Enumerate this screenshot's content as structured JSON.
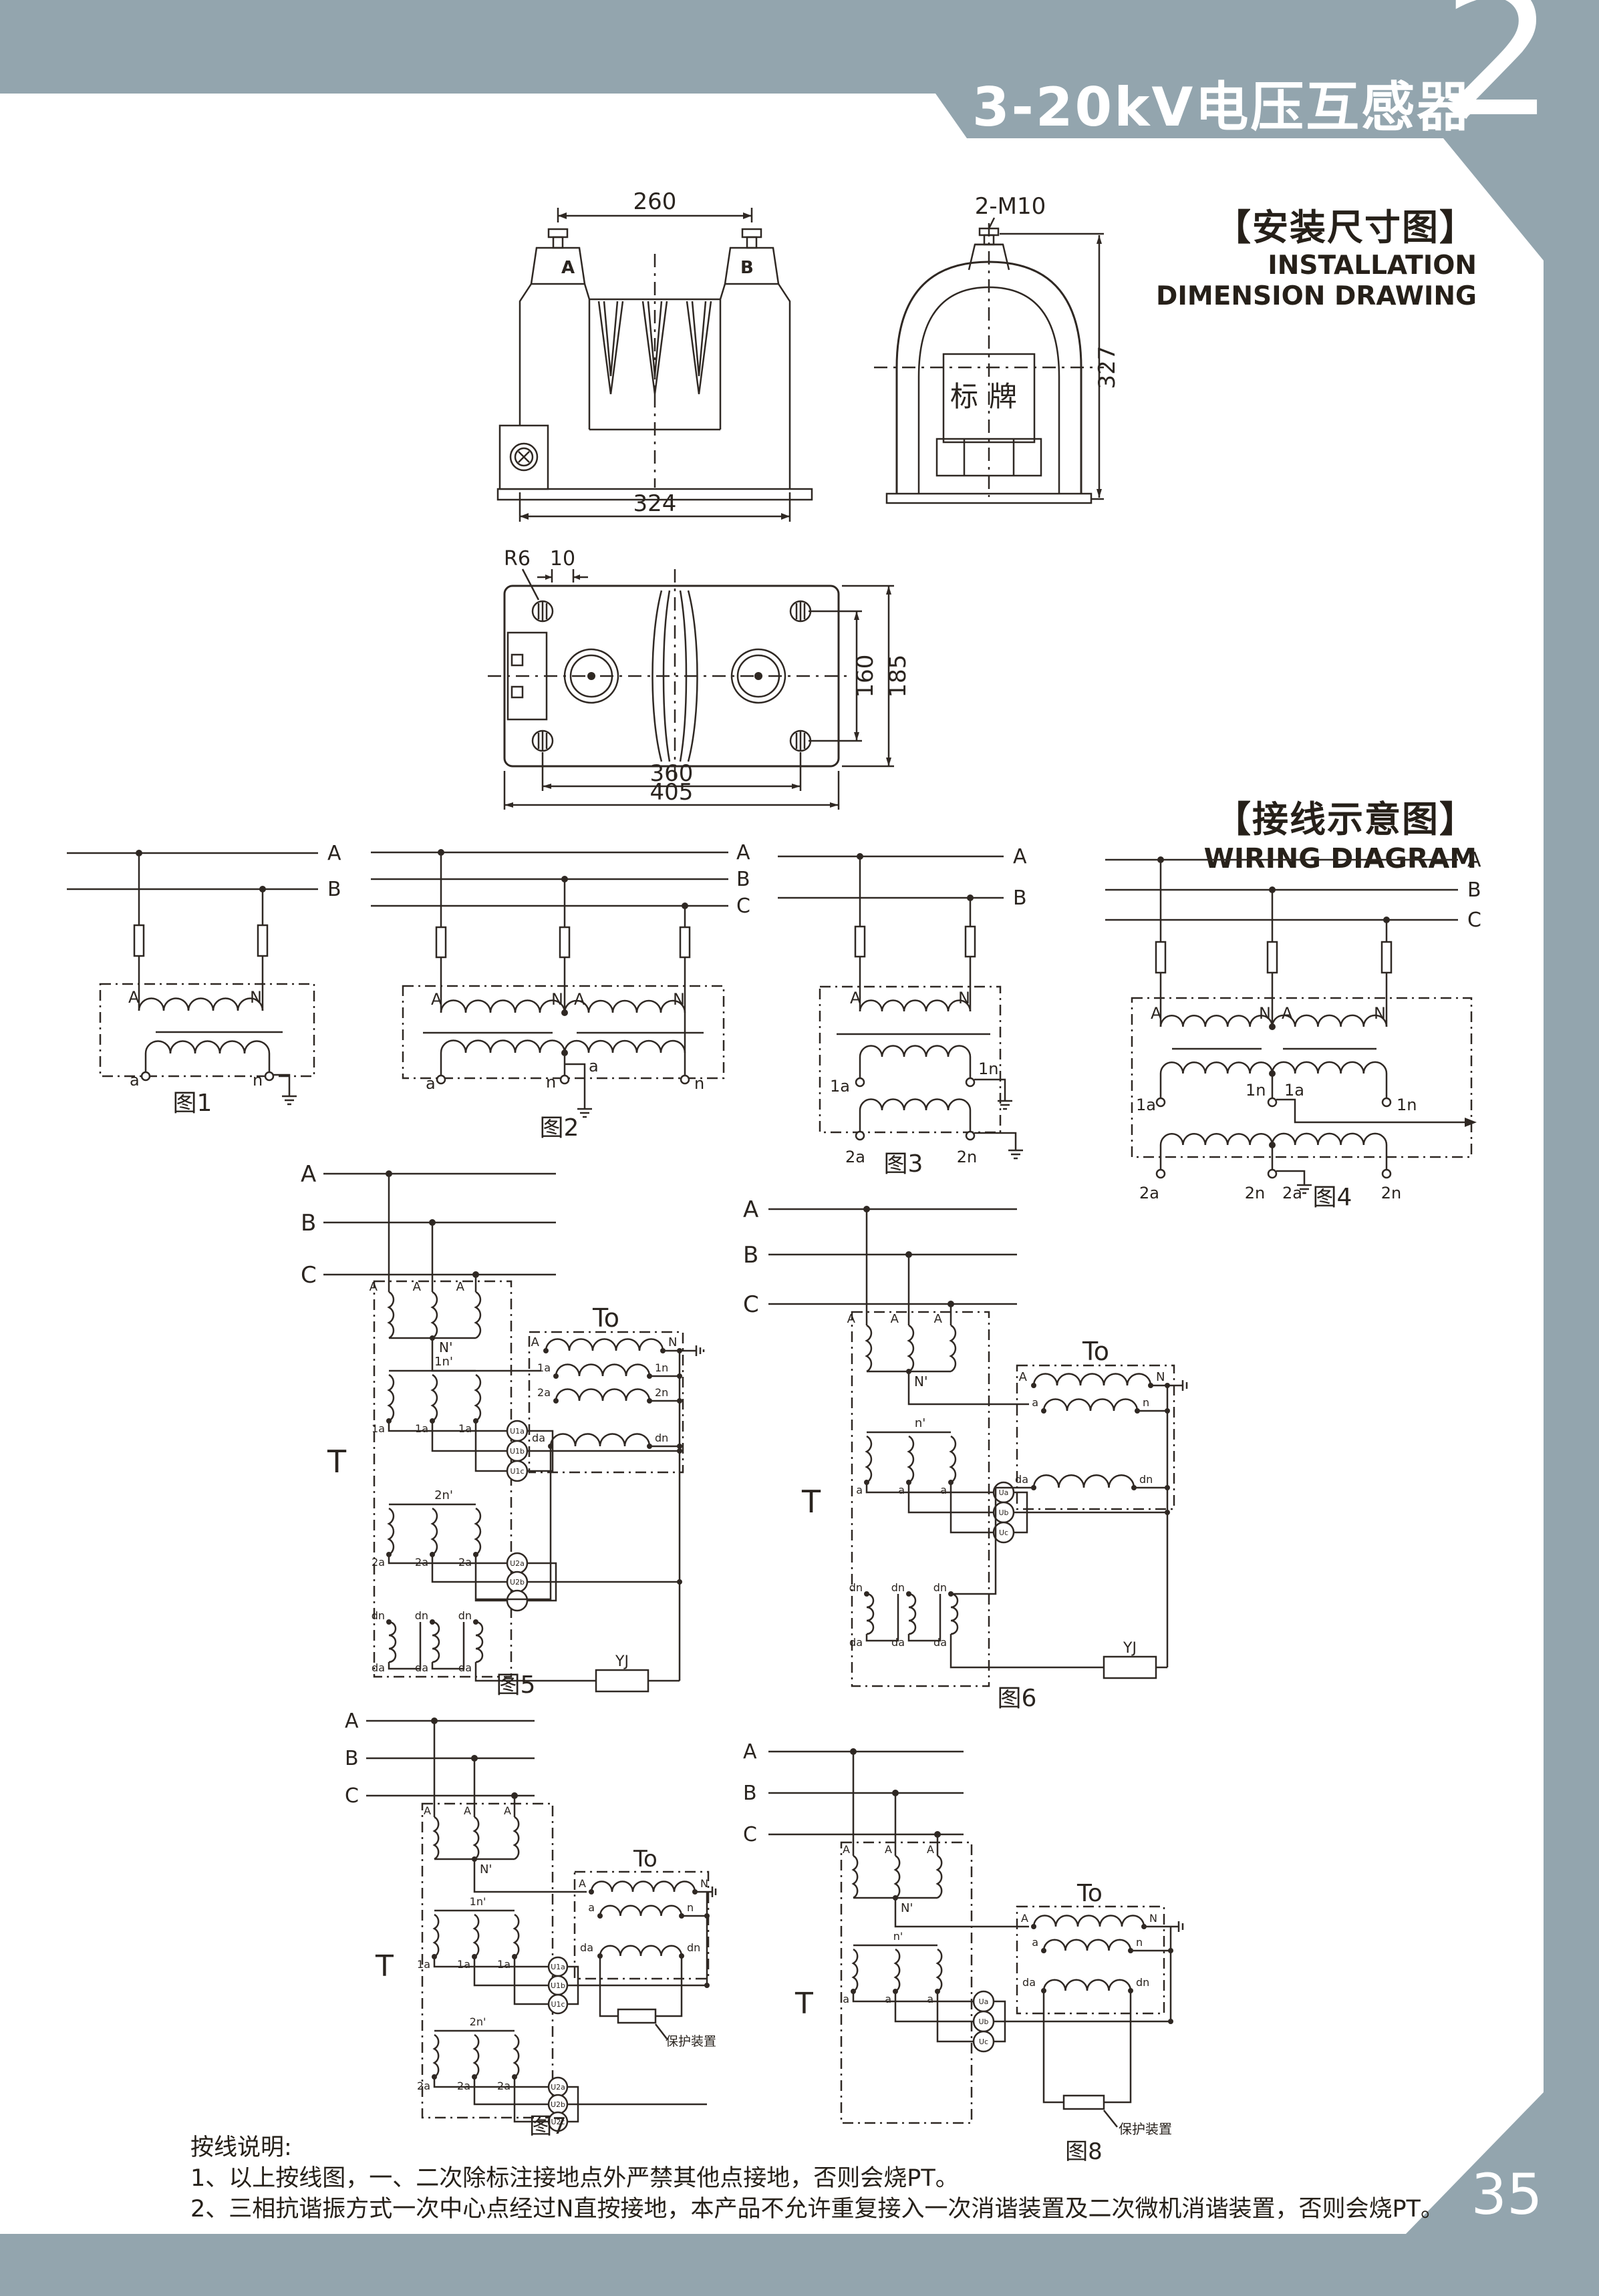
{
  "page": {
    "number": "35"
  },
  "header": {
    "title": "3-20kV电压互感器",
    "chapter": "2"
  },
  "install_section": {
    "zh": "【安装尺寸图】",
    "en_line1": "INSTALLATION",
    "en_line2": "DIMENSION DRAWING"
  },
  "wiring_section": {
    "zh": "【接线示意图】",
    "en": "WIRING DIAGRAM"
  },
  "front_view": {
    "dim_top": "260",
    "dim_bottom": "324",
    "label_a": "A",
    "label_b": "B"
  },
  "side_view": {
    "bolt_label": "2-M10",
    "nameplate": "标牌",
    "dim_height": "327"
  },
  "top_view": {
    "label_r": "R6",
    "label_10": "10",
    "dim_160": "160",
    "dim_185": "185",
    "dim_360": "360",
    "dim_405": "405"
  },
  "fig1": {
    "caption": "图1",
    "bus_a": "A",
    "bus_b": "B",
    "prim_a": "A",
    "prim_n": "N",
    "sec_a": "a",
    "sec_n": "n"
  },
  "fig2": {
    "caption": "图2",
    "bus_a": "A",
    "bus_b": "B",
    "bus_c": "C",
    "prim_a1": "A",
    "prim_n1": "N",
    "prim_a2": "A",
    "prim_n2": "N",
    "sec_a1": "a",
    "sec_n1": "n",
    "sec_tap": "a",
    "sec_n2": "n"
  },
  "fig3": {
    "caption": "图3",
    "bus_a": "A",
    "bus_b": "B",
    "prim_a": "A",
    "prim_n": "N",
    "sec1_a": "1a",
    "sec1_n": "1n",
    "sec2_a": "2a",
    "sec2_n": "2n"
  },
  "fig4": {
    "caption": "图4",
    "bus_a": "A",
    "bus_b": "B",
    "bus_c": "C",
    "prim_a1": "A",
    "prim_n1": "N",
    "prim_a2": "A",
    "prim_n2": "N",
    "sec1_a1": "1a",
    "sec1_n1": "1n",
    "sec1_a2": "1a",
    "sec1_n2": "1n",
    "sec2_a1": "2a",
    "sec2_n1": "2n",
    "sec2_a2": "2a",
    "sec2_n2": "2n"
  },
  "fig5": {
    "caption": "图5",
    "t": "T",
    "to": "To",
    "bus_a": "A",
    "bus_b": "B",
    "bus_c": "C",
    "p1": "A",
    "p2": "A",
    "p3": "A",
    "np": "N'",
    "r2_top": "1n'",
    "r2_b1": "1a",
    "r2_b2": "1a",
    "r2_b3": "1a",
    "r3_top": "2n'",
    "r3_b1": "2a",
    "r3_b2": "2a",
    "r3_b3": "2a",
    "r4_t1": "dn",
    "r4_t2": "dn",
    "r4_t3": "dn",
    "r4_b1": "da",
    "r4_b2": "da",
    "r4_b3": "da",
    "lamp1": "U1a",
    "lamp2": "U1b",
    "lamp3": "U1c",
    "lamp4": "U2a",
    "lamp5": "U2b",
    "lamp6": "U2c",
    "to_a": "A",
    "to_n": "N",
    "to_1a": "1a",
    "to_1n": "1n",
    "to_2a": "2a",
    "to_2n": "2n",
    "to_da": "da",
    "to_dn": "dn",
    "yj": "YJ"
  },
  "fig6": {
    "caption": "图6",
    "t": "T",
    "to": "To",
    "bus_a": "A",
    "bus_b": "B",
    "bus_c": "C",
    "p1": "A",
    "p2": "A",
    "p3": "A",
    "np": "N'",
    "r2_top": "n'",
    "r2_b1": "a",
    "r2_b2": "a",
    "r2_b3": "a",
    "r3_t1": "dn",
    "r3_t2": "dn",
    "r3_t3": "dn",
    "r3_b1": "da",
    "r3_b2": "da",
    "r3_b3": "da",
    "lamp1": "Ua",
    "lamp2": "Ub",
    "lamp3": "Uc",
    "to_a": "A",
    "to_n": "N",
    "to_sa": "a",
    "to_sn": "n",
    "to_da": "da",
    "to_dn": "dn",
    "yj": "YJ"
  },
  "fig7": {
    "caption": "图7",
    "t": "T",
    "to": "To",
    "bus_a": "A",
    "bus_b": "B",
    "bus_c": "C",
    "p1": "A",
    "p2": "A",
    "p3": "A",
    "np": "N'",
    "r2_top": "1n'",
    "r2_b1": "1a",
    "r2_b2": "1a",
    "r2_b3": "1a",
    "r3_top": "2n'",
    "r3_b1": "2a",
    "r3_b2": "2a",
    "r3_b3": "2a",
    "lamp1": "U1a",
    "lamp2": "U1b",
    "lamp3": "U1c",
    "lamp4": "U2a",
    "lamp5": "U2b",
    "lamp6": "U2c",
    "to_a": "A",
    "to_n": "N",
    "to_sa": "a",
    "to_sn": "n",
    "to_da": "da",
    "to_dn": "dn",
    "protect": "保护装置"
  },
  "fig8": {
    "caption": "图8",
    "t": "T",
    "to": "To",
    "bus_a": "A",
    "bus_b": "B",
    "bus_c": "C",
    "p1": "A",
    "p2": "A",
    "p3": "A",
    "np": "N'",
    "r2_top": "n'",
    "r2_b1": "a",
    "r2_b2": "a",
    "r2_b3": "a",
    "lamp1": "Ua",
    "lamp2": "Ub",
    "lamp3": "Uc",
    "to_a": "A",
    "to_n": "N",
    "to_sa": "a",
    "to_sn": "n",
    "to_da": "da",
    "to_dn": "dn",
    "protect": "保护装置"
  },
  "notes": {
    "title": "按线说明:",
    "line1": "1、以上按线图，一、二次除标注接地点外严禁其他点接地，否则会烧PT。",
    "line2": "2、三相抗谐振方式一次中心点经过N直按接地，本产品不允许重复接入一次消谐装置及二次微机消谐装置，否则会烧PT。"
  }
}
